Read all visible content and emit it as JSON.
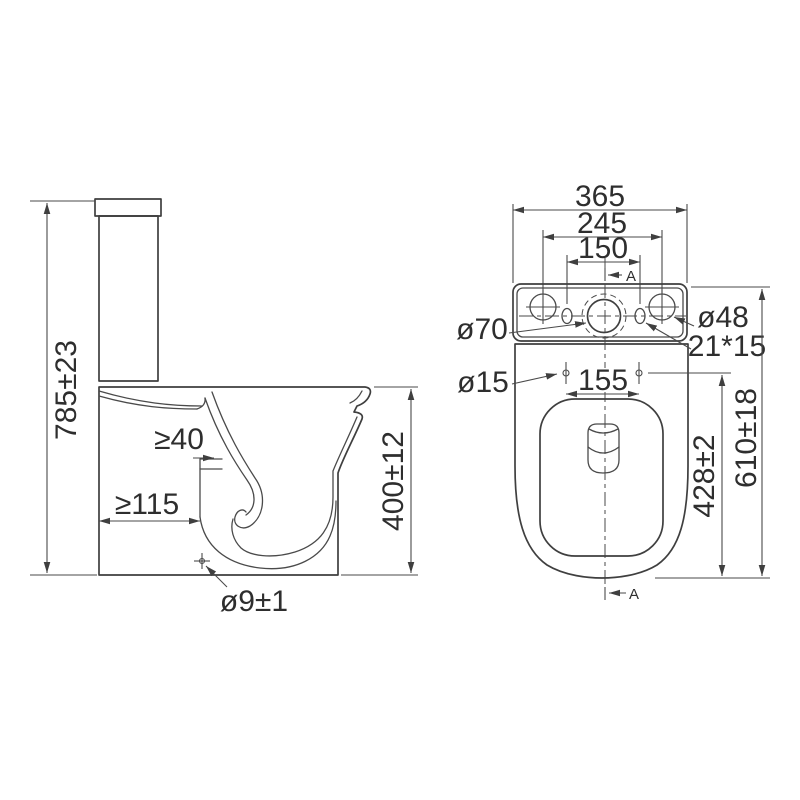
{
  "style": {
    "background": "#ffffff",
    "line_color": "#3f3f3f",
    "text_color": "#2e2e2e"
  },
  "side_view": {
    "overall_height": "785±23",
    "bowl_height": "400±12",
    "min_outlet_distance": "≥115",
    "min_gap": "≥40",
    "fixing_hole_diameter": "ø9±1"
  },
  "top_view": {
    "overall_width": "365",
    "tank_hole_spacing": "245",
    "inlet_spacing": "150",
    "seat_fixing_spacing": "155",
    "tank_center_hole_diameter": "ø70",
    "tank_side_hole_diameter": "ø48",
    "tank_slot_size": "21*15",
    "seat_fixing_hole_diameter": "ø15",
    "bowl_fixing_length": "428±2",
    "overall_depth": "610±18",
    "section_label": "A"
  }
}
